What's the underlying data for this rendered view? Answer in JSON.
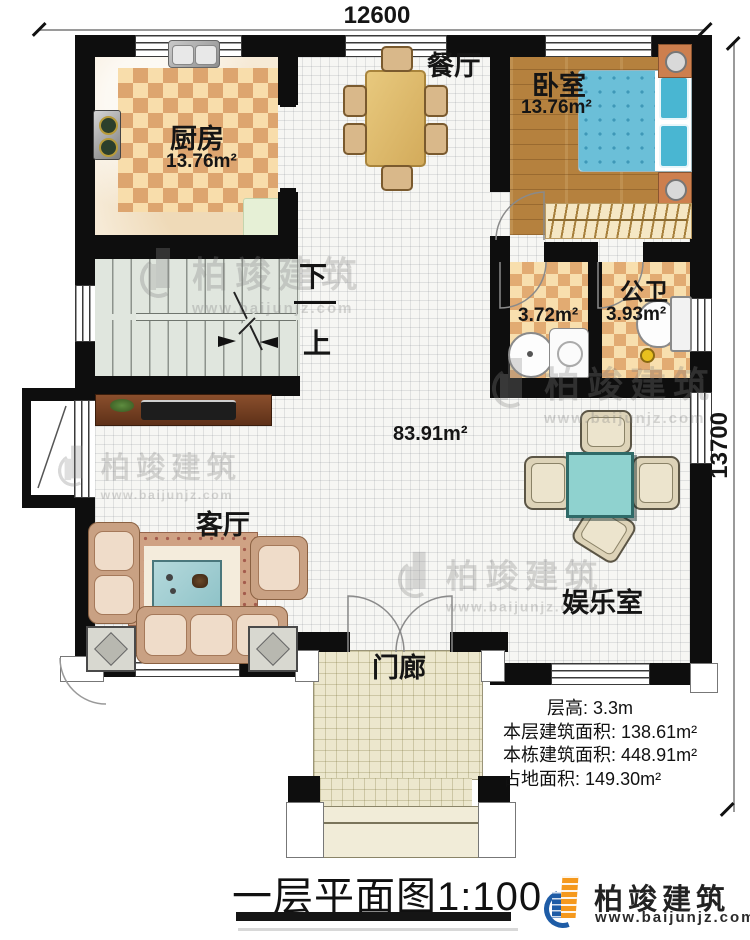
{
  "plan": {
    "dim_top": "12600",
    "dim_right": "13700",
    "rooms": {
      "kitchen": {
        "name": "厨房",
        "area": "13.76m²"
      },
      "dining": {
        "name": "餐厅"
      },
      "bedroom": {
        "name": "卧室",
        "area": "13.76m²"
      },
      "washroom": {
        "area": "3.72m²"
      },
      "public_bath": {
        "name": "公卫",
        "area": "3.93m²"
      },
      "hall": {
        "area": "83.91m²"
      },
      "living": {
        "name": "客厅"
      },
      "entertainment": {
        "name": "娱乐室"
      },
      "porch": {
        "name": "门廊"
      },
      "stair_down": "下",
      "stair_up": "上"
    },
    "stats": [
      {
        "label": "层高:",
        "value": "3.3m"
      },
      {
        "label": "本层建筑面积:",
        "value": "138.61m²"
      },
      {
        "label": "本栋建筑面积:",
        "value": "448.91m²"
      },
      {
        "label": "占地面积:",
        "value": "149.30m²"
      }
    ],
    "title": "一层平面图1:100",
    "brand": {
      "name": "柏竣建筑",
      "url": "www.baijunjz.com"
    },
    "watermark": {
      "name": "柏竣建筑",
      "url": "www.baijunjz.com"
    },
    "colors": {
      "wall": "#0e0e0e",
      "wood_floor": "#b5813e",
      "checker_tile": "#dda56f",
      "bed": "#6bbfd8",
      "game_table": "#8fd2cf",
      "logo_blue": "#1e5ca6",
      "logo_orange": "#f5991d"
    }
  }
}
